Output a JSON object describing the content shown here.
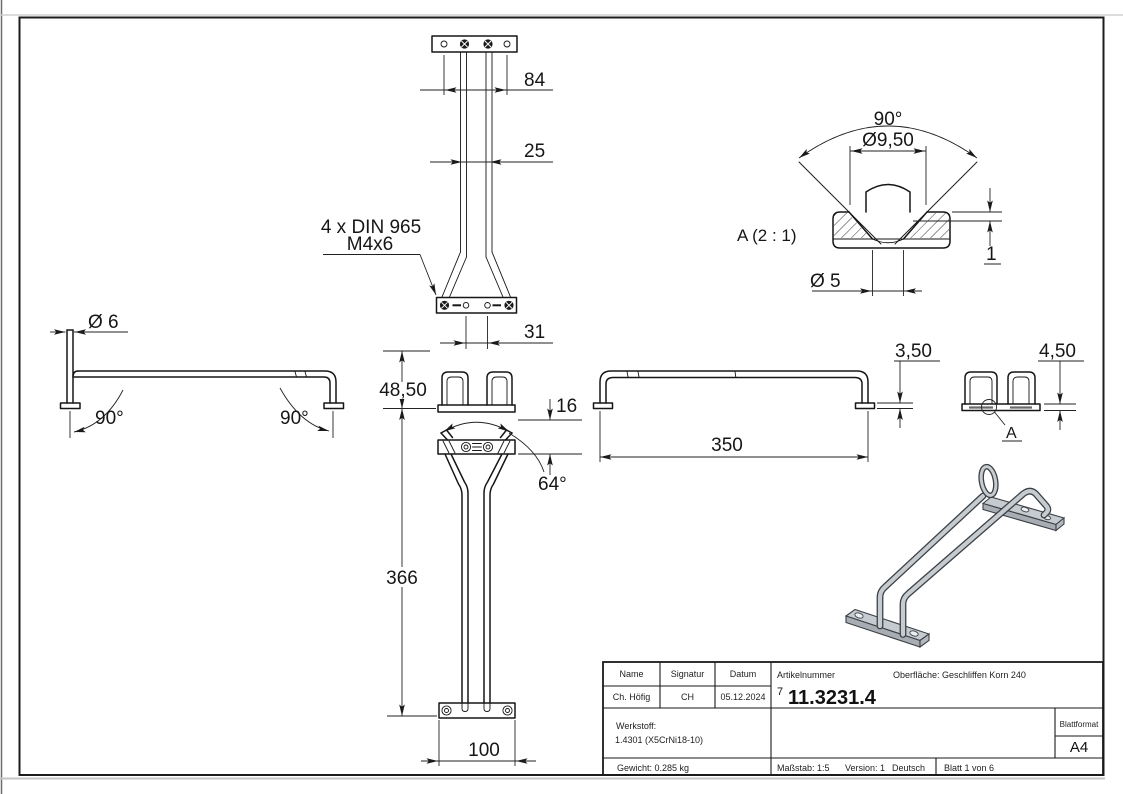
{
  "views": {
    "rear": {
      "dim_plate_width": "84",
      "dim_rod_spacing": "25",
      "dim_hole_spacing": "31",
      "note_line1": "4 x DIN 965",
      "note_line2": "M4x6"
    },
    "front": {
      "dim_head_height": "48,50",
      "dim_plate_height": "16",
      "dim_angle": "64°",
      "dim_height": "366",
      "dim_base_width": "100"
    },
    "left_side": {
      "dim_wire_dia": "Ø 6",
      "dim_angle_left": "90°",
      "dim_angle_right": "90°"
    },
    "right_side": {
      "dim_length": "350",
      "dim_plate_thickness": "3,50"
    },
    "rail_end": {
      "dim_plate_thickness": "4,50",
      "detail_marker": "A"
    },
    "detail_a": {
      "title": "A (2 : 1)",
      "dim_countersink_angle": "90°",
      "dim_countersink_dia": "Ø9,50",
      "dim_hole_dia": "Ø 5",
      "dim_depth": "1"
    }
  },
  "title_block": {
    "name_label": "Name",
    "signature_label": "Signatur",
    "date_label": "Datum",
    "name_value": "Ch. Höfig",
    "signature_value": "CH",
    "date_value": "05.12.2024",
    "article_label": "Artikelnummer",
    "surface_label": "Oberfläche:  Geschliffen Korn 240",
    "article_prefix": "7",
    "article_number": "11.3231.4",
    "material_label": "Werkstoff:",
    "material_value": "1.4301 (X5CrNi18-10)",
    "weight_label": "Gewicht: 0.285 kg",
    "scale_label": "Maßstab: 1:5",
    "version_label": "Version: 1",
    "language_label": "Deutsch",
    "sheet_label": "Blatt 1 von 6",
    "format_label": "Blattformat",
    "format_value": "A4"
  }
}
